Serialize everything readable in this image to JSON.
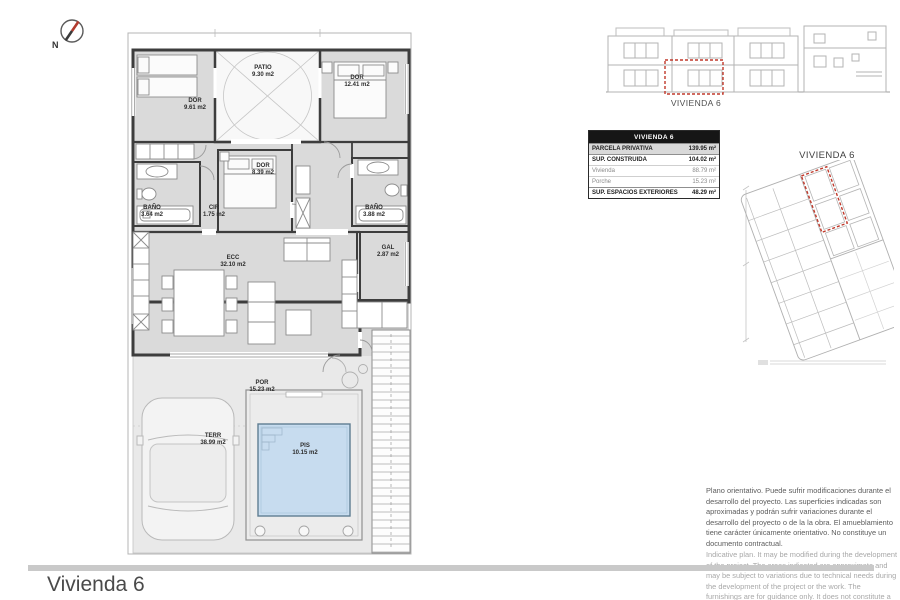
{
  "page": {
    "bottom_title": "Vivienda 6"
  },
  "plan": {
    "north_label": "N",
    "rooms": [
      {
        "id": "dor1",
        "name": "DOR",
        "area": "9.61 m2"
      },
      {
        "id": "patio",
        "name": "PATIO",
        "area": "9.30 m2"
      },
      {
        "id": "dor2",
        "name": "DOR",
        "area": "12.41 m2"
      },
      {
        "id": "dor3",
        "name": "DOR",
        "area": "8.39 m2"
      },
      {
        "id": "bano1",
        "name": "BAÑO",
        "area": "3.64 m2"
      },
      {
        "id": "cir",
        "name": "CIR",
        "area": "1.75 m2"
      },
      {
        "id": "bano2",
        "name": "BAÑO",
        "area": "3.88 m2"
      },
      {
        "id": "ecc",
        "name": "ECC",
        "area": "32.10 m2"
      },
      {
        "id": "gal",
        "name": "GAL",
        "area": "2.87 m2"
      },
      {
        "id": "por",
        "name": "POR",
        "area": "15.23 m2"
      },
      {
        "id": "terr",
        "name": "TERR",
        "area": "38.99 m2"
      },
      {
        "id": "pis",
        "name": "PIS",
        "area": "10.15 m2"
      }
    ]
  },
  "elevation": {
    "label": "VIVIENDA 6"
  },
  "site_plan": {
    "label": "VIVIENDA 6"
  },
  "area_table": {
    "header": "VIVIENDA 6",
    "rows": [
      {
        "label": "PARCELA PRIVATIVA",
        "value": "139.95 m²"
      },
      {
        "label": "SUP. CONSTRUIDA",
        "value": "104.02 m²"
      },
      {
        "label": "Vivienda",
        "value": "88.79 m²"
      },
      {
        "label": "Porche",
        "value": "15.23 m²"
      },
      {
        "label": "SUP. ESPACIOS EXTERIORES",
        "value": "48.29 m²"
      }
    ]
  },
  "disclaimer": {
    "es": "Plano orientativo. Puede sufrir modificaciones durante el desarrollo del proyecto. Las superficies indicadas son aproximadas y podrán sufrir variaciones durante el desarrollo del proyecto o de la la obra. El amueblamiento tiene carácter únicamente orientativo. No constituye un documento contractual.",
    "en": "Indicative plan. It may be modified during the development of the project. The areas indicated are approximate and may be subject to variations due to technical needs during the development of the project or the work. The furnishings are for guidance only. It does not constitute a contractual document."
  },
  "colors": {
    "accent_red": "#c0392b",
    "pool_blue": "#c7dcef",
    "room_gray": "#dadada",
    "wall": "#3d3d3d"
  }
}
